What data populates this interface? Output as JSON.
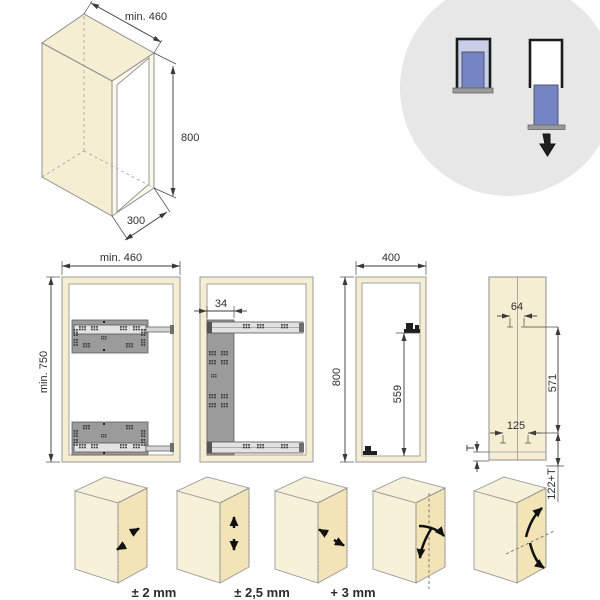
{
  "title": "Pull-out frame installation drawing",
  "colors": {
    "cream": "#F6EED3",
    "panel_face": "#F2E4B6",
    "plate_gray": "#9B9B9B",
    "rail_gray": "#E2E2E2",
    "outline": "#999999",
    "dimension": "#3A3A3A",
    "badge_circle": "#E7E7E7",
    "accent_blue": "#7585C4",
    "accent_blue_light": "#C9CFE8",
    "arrow_black": "#111111"
  },
  "iso_cabinet": {
    "depth": "min. 460",
    "height": "800",
    "width": "300"
  },
  "front_view": {
    "width": "min. 460",
    "height": "min. 750"
  },
  "side_view": {
    "plate_offset": "34"
  },
  "opening_view": {
    "width": "400",
    "height": "800",
    "bracket_height": "559"
  },
  "panel_view": {
    "hole_spacing": "64",
    "length": "571",
    "bottom_hole_spacing": "125",
    "thickness": "T",
    "bottom_offset": "122+T"
  },
  "adjustments": {
    "lateral": "± 2 mm",
    "vertical": "± 2,5 mm",
    "depth": "+ 3 mm"
  },
  "badge_icons": [
    "panel-inserted-icon",
    "panel-slide-in-icon",
    "insert-direction-down-arrow-icon"
  ]
}
